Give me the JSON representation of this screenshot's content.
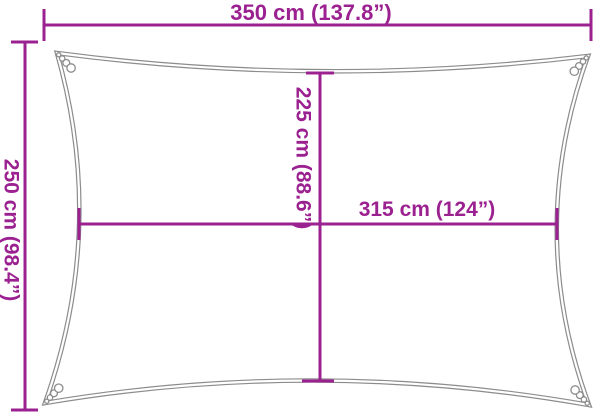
{
  "figure": {
    "type": "product-dimension-diagram",
    "subject": "rectangular shade sail outline with concave edges and corner rings",
    "accent_color": "#9B2190",
    "outline_color": "#8C8C8C",
    "background_color": "#FFFFFF",
    "labels": {
      "top_width": "350 cm (137.8”)",
      "left_height": "250 cm (98.4”)",
      "inner_height": "225 cm (88.6”)",
      "inner_width": "315 cm (124”)"
    },
    "measurements": [
      {
        "name": "overall width",
        "cm": 350,
        "inches": 137.8
      },
      {
        "name": "overall height",
        "cm": 250,
        "inches": 98.4
      },
      {
        "name": "inner height",
        "cm": 225,
        "inches": 88.6
      },
      {
        "name": "inner width",
        "cm": 315,
        "inches": 124
      }
    ]
  }
}
